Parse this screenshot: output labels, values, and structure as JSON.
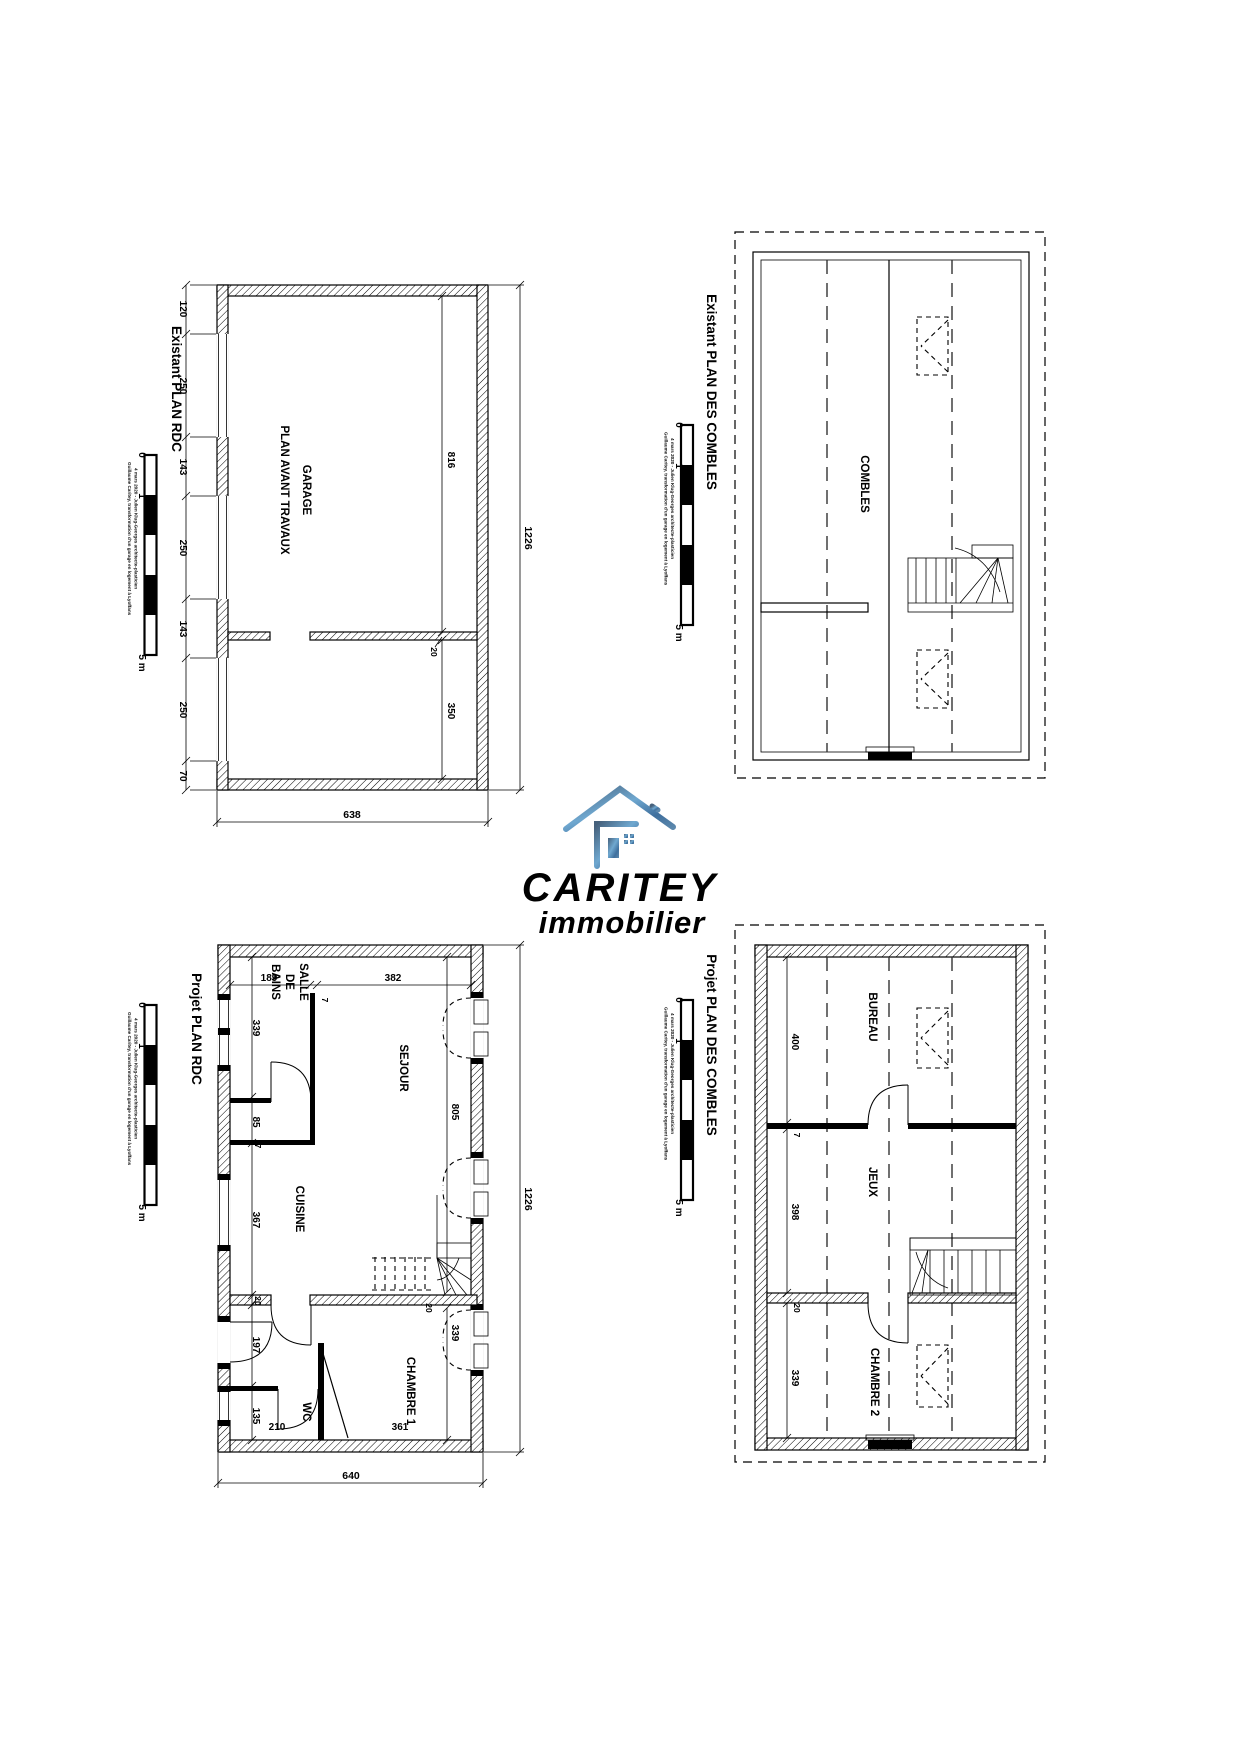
{
  "logo": {
    "brand": "CARITEY",
    "tagline": "immobilier",
    "accent": "#4b9cd3",
    "dark": "#46617c"
  },
  "scalebar": {
    "zero": "0",
    "one": "1",
    "five": "5 m",
    "credit_line1": "Guillaume Caritey, transformation d'un garage en logement à Lyoffans",
    "credit_line2": "4 mars 2020 - Julien Klug-Georges architecte-plasticien"
  },
  "plans": {
    "existant_rdc": {
      "title": "Existant PLAN RDC",
      "room_line1": "GARAGE",
      "room_line2": "PLAN AVANT TRAVAUX",
      "chain": [
        "120",
        "250",
        "143",
        "250",
        "143",
        "250",
        "70"
      ],
      "dim_length": "1226",
      "dim_width": "638",
      "dim_garage": "816",
      "dim_wall": "20",
      "dim_back": "350"
    },
    "existant_combles": {
      "title": "Existant PLAN DES COMBLES",
      "room": "COMBLES"
    },
    "projet_rdc": {
      "title": "Projet PLAN RDC",
      "rooms": {
        "sdb_l1": "SALLE",
        "sdb_l2": "DE",
        "sdb_l3": "BAINS",
        "sejour": "SEJOUR",
        "cuisine": "CUISINE",
        "wc": "WC",
        "chambre": "CHAMBRE 1"
      },
      "chain": [
        "339",
        "7",
        "85",
        "7",
        "367",
        "20",
        "197",
        "7",
        "135"
      ],
      "d189": "189",
      "d382": "382",
      "d7": "7",
      "d805": "805",
      "d20": "20",
      "d339": "339",
      "d361": "361",
      "d210": "210",
      "d640": "640",
      "d1226": "1226"
    },
    "projet_combles": {
      "title": "Projet PLAN DES COMBLES",
      "rooms": {
        "bureau": "BUREAU",
        "jeux": "JEUX",
        "chambre2": "CHAMBRE 2"
      },
      "d400": "400",
      "d7": "7",
      "d398": "398",
      "d20": "20",
      "d339": "339"
    }
  }
}
